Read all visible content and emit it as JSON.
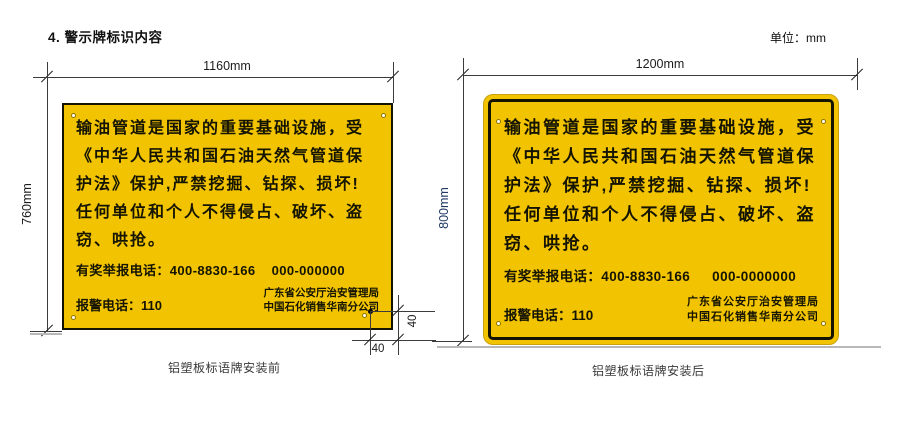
{
  "header": {
    "section_title": "4. 警示牌标识内容",
    "unit_label": "单位：mm"
  },
  "signs": [
    {
      "caption": "铝塑板标语牌安装前",
      "dims": {
        "width": "1160mm",
        "height": "760mm",
        "hole_offset_x": "40",
        "hole_offset_y": "40"
      },
      "body_lines": [
        "输油管道是国家的重要基础设施，受",
        "《中华人民共和国石油天然气管道保",
        "护法》保护,严禁挖掘、钻探、损坏!",
        "任何单位和个人不得侵占、破坏、盗",
        "窃、哄抢。"
      ],
      "hotline_label": "有奖举报电话：400-8830-166",
      "hotline_alt": "000-000000",
      "police_label": "报警电话：110",
      "org_lines": [
        "广东省公安厅治安管理局",
        "中国石化销售华南分公司"
      ]
    },
    {
      "caption": "铝塑板标语牌安装后",
      "dims": {
        "width": "1200mm",
        "height": "800mm"
      },
      "body_lines": [
        "输油管道是国家的重要基础设施，受",
        "《中华人民共和国石油天然气管道保",
        "护法》保护,严禁挖掘、钻探、损坏!",
        "任何单位和个人不得侵占、破坏、盗",
        "窃、哄抢。"
      ],
      "hotline_label": "有奖举报电话：400-8830-166",
      "hotline_alt": "000-0000000",
      "police_label": "报警电话：110",
      "org_lines": [
        "广东省公安厅治安管理局",
        "中国石化销售华南分公司"
      ]
    }
  ],
  "colors": {
    "sign_yellow": "#F2C300",
    "sign_border": "#141400",
    "dim_line": "#3C3C3C",
    "height_label_right": "#1F3864",
    "ground_line": "#B8B8B8"
  }
}
